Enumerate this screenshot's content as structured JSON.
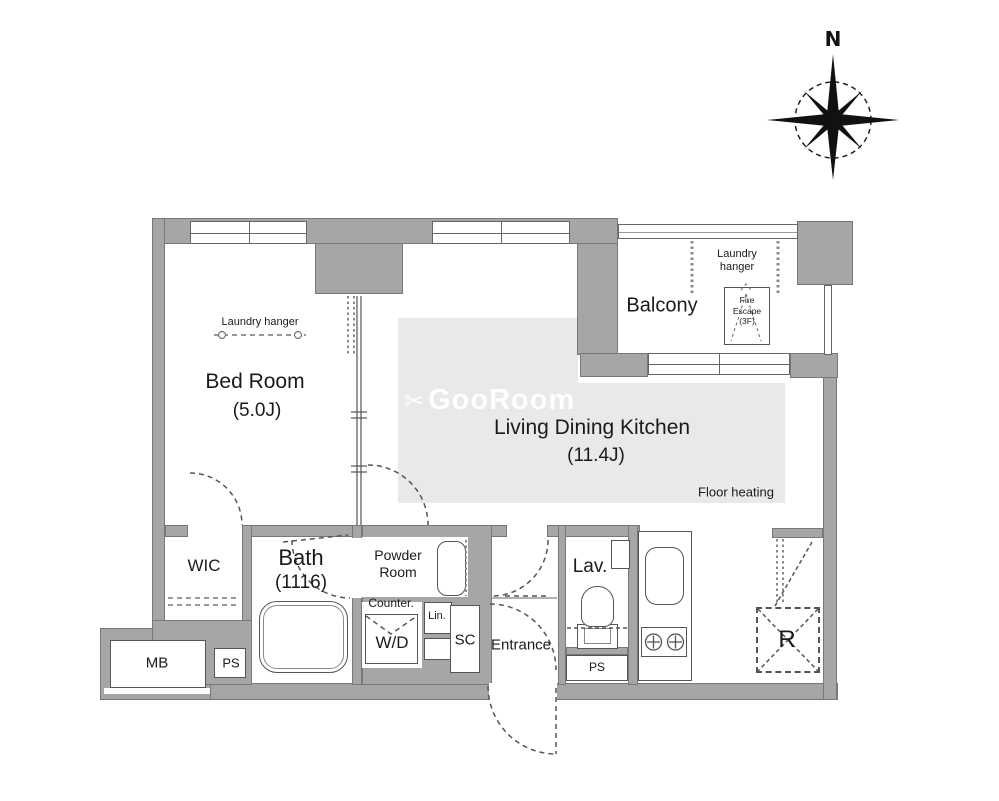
{
  "compass": {
    "north_label": "N"
  },
  "watermark": {
    "icon": "✂",
    "text": "GooRoom"
  },
  "rooms": {
    "bedroom": {
      "name": "Bed Room",
      "size": "(5.0J)"
    },
    "ldk": {
      "name": "Living Dining Kitchen",
      "size": "(11.4J)"
    },
    "balcony": {
      "name": "Balcony"
    },
    "wic": {
      "name": "WIC"
    },
    "bath": {
      "name": "Bath",
      "size": "(1116)"
    },
    "powder_room": {
      "name": "Powder Room"
    },
    "entrance": {
      "name": "Entrance"
    },
    "lavatory": {
      "name": "Lav."
    },
    "shoe_closet": {
      "name": "SC"
    },
    "washer_dryer": {
      "name": "W/D"
    },
    "linen": {
      "name": "Lin."
    },
    "counter": {
      "name": "Counter."
    },
    "meter_box": {
      "name": "MB"
    },
    "pipe_space_left": {
      "name": "PS"
    },
    "pipe_space_right": {
      "name": "PS"
    },
    "refrigerator": {
      "name": "R"
    }
  },
  "annotations": {
    "laundry_hanger_bedroom": "Laundry hanger",
    "laundry_hanger_balcony": "Laundry hanger",
    "floor_heating": "Floor heating",
    "fire_escape": {
      "line1": "Fire",
      "line2": "Escape",
      "line3": "(3F)"
    }
  },
  "colors": {
    "wall": "#a6a6a6",
    "wall_outline": "#787878",
    "floor_heating_fill": "#e9e9e9",
    "line": "#555555",
    "text": "#1b1b1b",
    "watermark": "rgba(255,255,255,0.92)"
  }
}
